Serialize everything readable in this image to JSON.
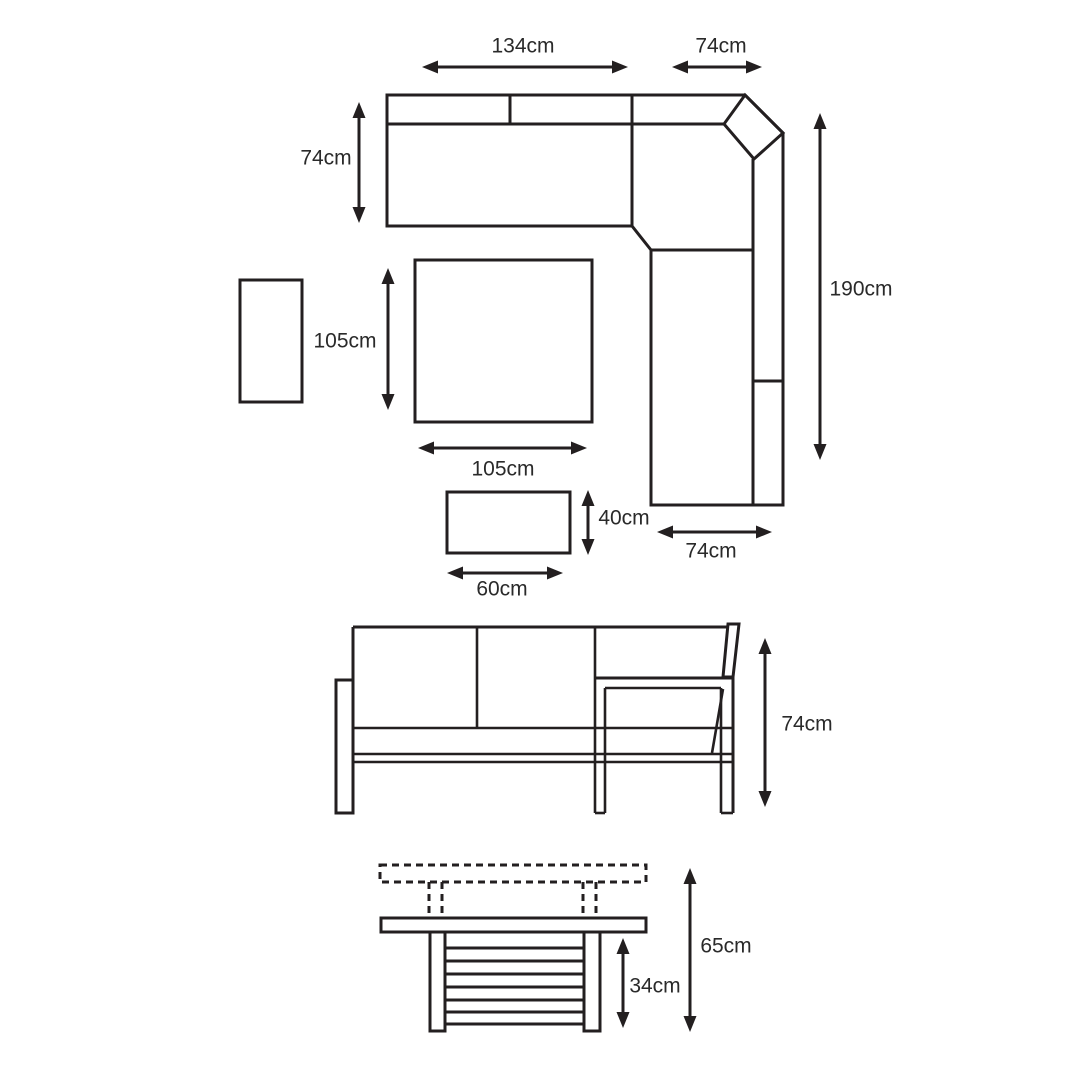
{
  "page": {
    "background": "#ffffff",
    "line_color": "#231f20",
    "text_color": "#2a2a2a"
  },
  "views": {
    "plan": {
      "name": "corner-sofa-set-plan-view",
      "dimensions": [
        {
          "id": "left-sofa-width",
          "label": "134cm"
        },
        {
          "id": "corner-section-width",
          "label": "74cm"
        },
        {
          "id": "sofa-depth",
          "label": "74cm"
        },
        {
          "id": "right-sofa-length",
          "label": "190cm"
        },
        {
          "id": "table-depth",
          "label": "105cm"
        },
        {
          "id": "table-width",
          "label": "105cm"
        },
        {
          "id": "bench-depth",
          "label": "40cm"
        },
        {
          "id": "bench-width",
          "label": "60cm"
        },
        {
          "id": "right-sofa-width",
          "label": "74cm"
        }
      ]
    },
    "sofa_elevation": {
      "name": "sofa-front-elevation",
      "dimensions": [
        {
          "id": "sofa-height",
          "label": "74cm"
        }
      ]
    },
    "table_elevation": {
      "name": "adjustable-table-side-elevation",
      "dimensions": [
        {
          "id": "table-raised-height",
          "label": "65cm"
        },
        {
          "id": "table-lowered-height",
          "label": "34cm"
        }
      ]
    }
  }
}
